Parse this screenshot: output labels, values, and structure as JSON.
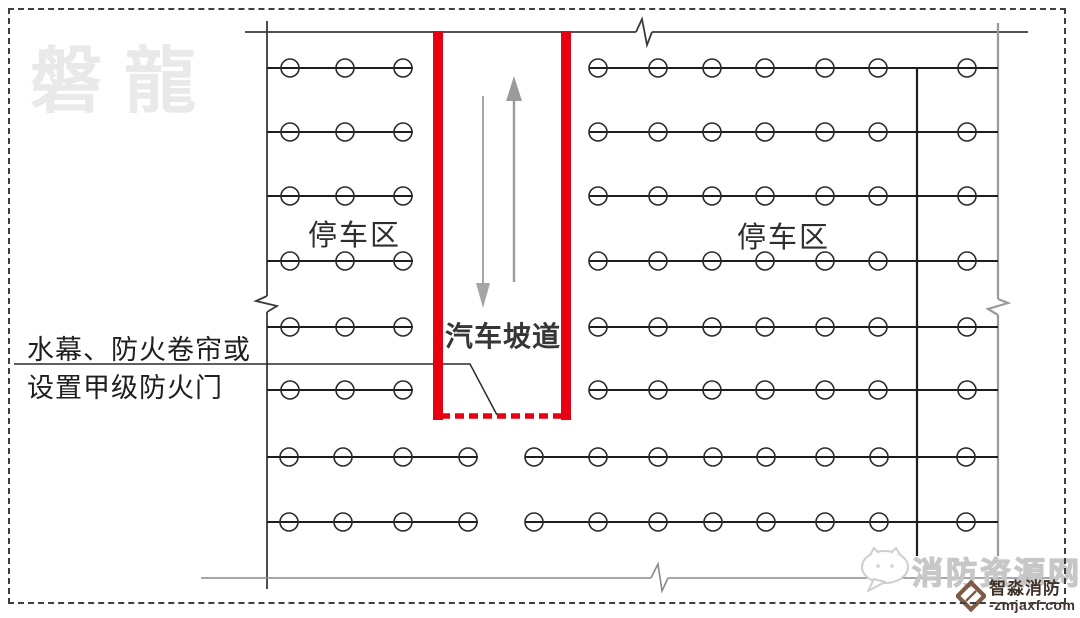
{
  "watermark_top_left": "磐龍",
  "labels": {
    "left_parking": "停车区",
    "right_parking": "停车区",
    "ramp": "汽车坡道",
    "annotation_line1": "水幕、防火卷帘或",
    "annotation_line2": "设置甲级防火门"
  },
  "watermark_bottom_right": {
    "site_name": "消防资源网",
    "brand_name": "智淼消防",
    "brand_url": "-zmjaxf.com"
  },
  "colors": {
    "ramp_red": "#e60012",
    "row_line_black": "#1d1d1d",
    "boundary_dark": "#3a3a3a",
    "boundary_gray": "#9a9a9a",
    "arrow_gray": "#9e9e9e",
    "watermark_light_gray": "#e9e9e9",
    "brand_brown": "#7d5b46"
  },
  "diagram": {
    "circle_radius": 9,
    "row_groups": [
      {
        "name": "left-parking-rows",
        "y": [
          68,
          132,
          196,
          261,
          327,
          390
        ],
        "line_x": [
          267,
          413
        ],
        "circles_x": [
          290,
          345,
          403
        ]
      },
      {
        "name": "right-parking-rows",
        "y": [
          68,
          132,
          196,
          261,
          327,
          390
        ],
        "line_x": [
          589,
          998
        ],
        "circles_x": [
          598,
          658,
          712,
          765,
          825,
          878,
          967
        ]
      },
      {
        "name": "lower-rows-left-segment",
        "y": [
          457,
          522
        ],
        "line_x": [
          267,
          478
        ],
        "circles_x": [
          289,
          343,
          403,
          468
        ]
      },
      {
        "name": "lower-rows-right-segment",
        "y": [
          457,
          522
        ],
        "line_x": [
          525,
          998
        ],
        "circles_x": [
          534,
          598,
          658,
          713,
          766,
          825,
          879,
          966
        ]
      }
    ]
  }
}
